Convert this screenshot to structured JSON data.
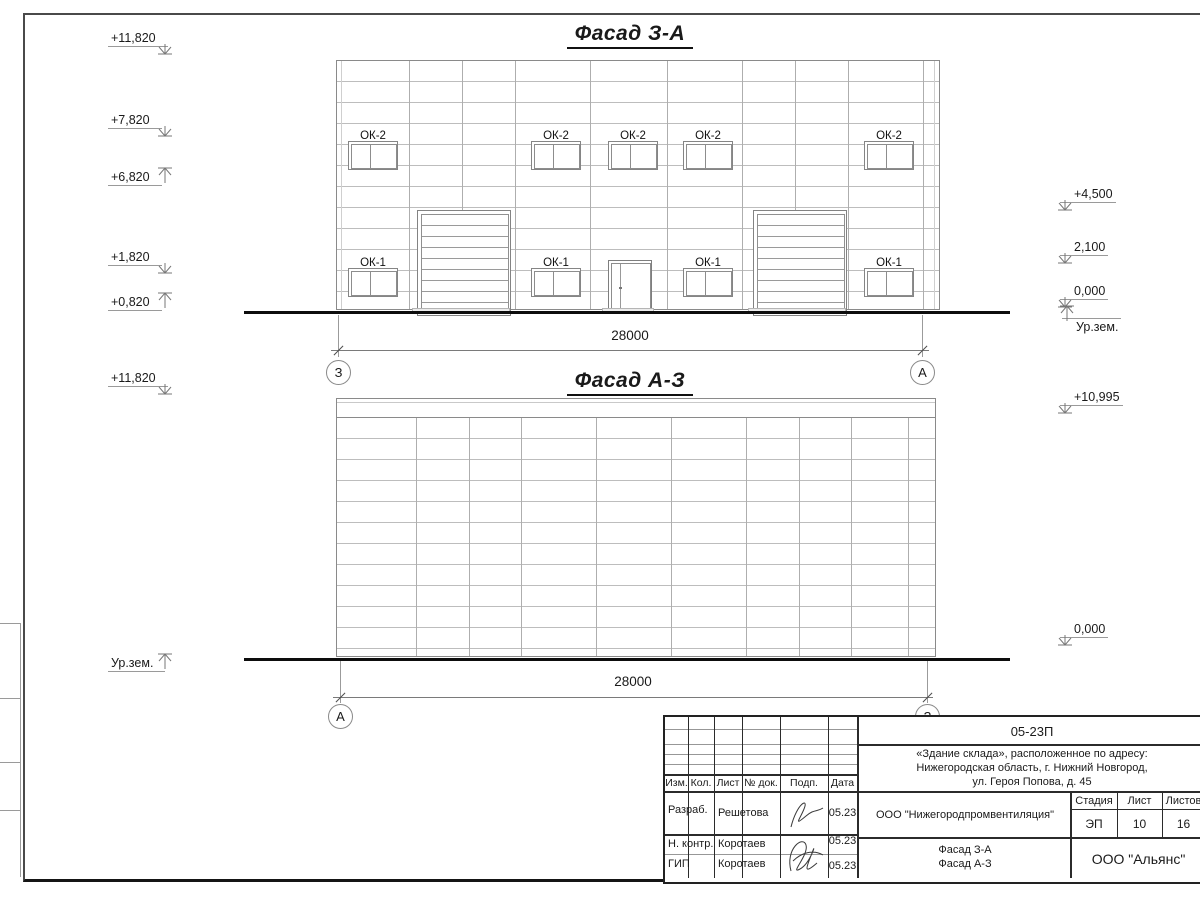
{
  "facade1": {
    "title": "Фасад З-А",
    "marks_left": [
      "+11,820",
      "+7,820",
      "+6,820",
      "+1,820",
      "+0,820"
    ],
    "marks_right": [
      "+4,500",
      "2,100",
      "0,000"
    ],
    "ground_label": "Ур.зем.",
    "window_top_label": "ОК-2",
    "window_bottom_label": "ОК-1",
    "dimension": "28000",
    "axis_left": "З",
    "axis_right": "А"
  },
  "facade2": {
    "title": "Фасад А-З",
    "mark_top_left": "+11,820",
    "mark_top_right": "+10,995",
    "mark_bottom_right": "0,000",
    "ground_label": "Ур.зем.",
    "dimension": "28000",
    "axis_left": "А",
    "axis_right": "З"
  },
  "titleblock": {
    "doc_code": "05-23П",
    "object_lines": [
      "«Здание склада», расположенное по адресу:",
      "Нижегородская область, г. Нижний Новгород,",
      "ул. Героя Попова, д. 45"
    ],
    "cols": [
      "Изм.",
      "Кол.",
      "Лист",
      "№ док.",
      "Подп.",
      "Дата"
    ],
    "rows": [
      {
        "role": "Разраб.",
        "name": "Решетова",
        "date": "05.23"
      },
      {
        "role": "Н. контр.",
        "name": "Коротаев",
        "date": "05.23"
      },
      {
        "role": "ГИП",
        "name": "Коротаев",
        "date": "05.23"
      }
    ],
    "designer": "ООО \"Нижегородпромвентиляция\"",
    "stage_cols": [
      "Стадия",
      "Лист",
      "Листов"
    ],
    "stage_vals": [
      "ЭП",
      "10",
      "16"
    ],
    "sheet_name": [
      "Фасад З-А",
      "Фасад А-З"
    ],
    "company": "ООО \"Альянс\""
  }
}
